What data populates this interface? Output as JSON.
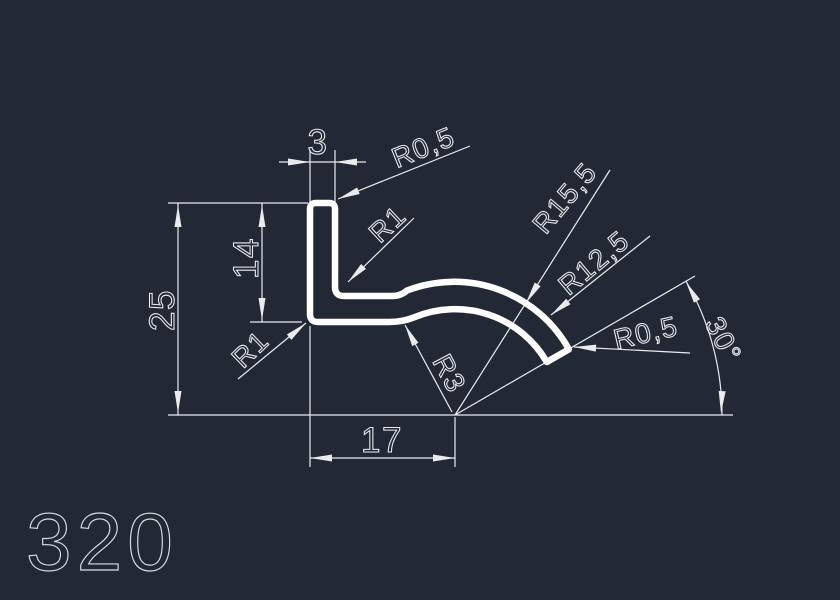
{
  "colors": {
    "background": "#232934",
    "dimension_lines": "#e9ebf0",
    "profile_outline": "#ffffff",
    "part_number_text": "#d8dce3"
  },
  "part": {
    "number": "320"
  },
  "dimensions": {
    "top_width": "3",
    "total_height": "25",
    "leg_height": "14",
    "bottom_width": "17",
    "end_angle": "30°"
  },
  "radii": {
    "top_corner": "R0,5",
    "bend_inner": "R1",
    "bend_outer": "R1",
    "outer_arc": "R15,5",
    "inner_arc": "R12,5",
    "web_fillet": "R3",
    "tip": "R0,5"
  }
}
